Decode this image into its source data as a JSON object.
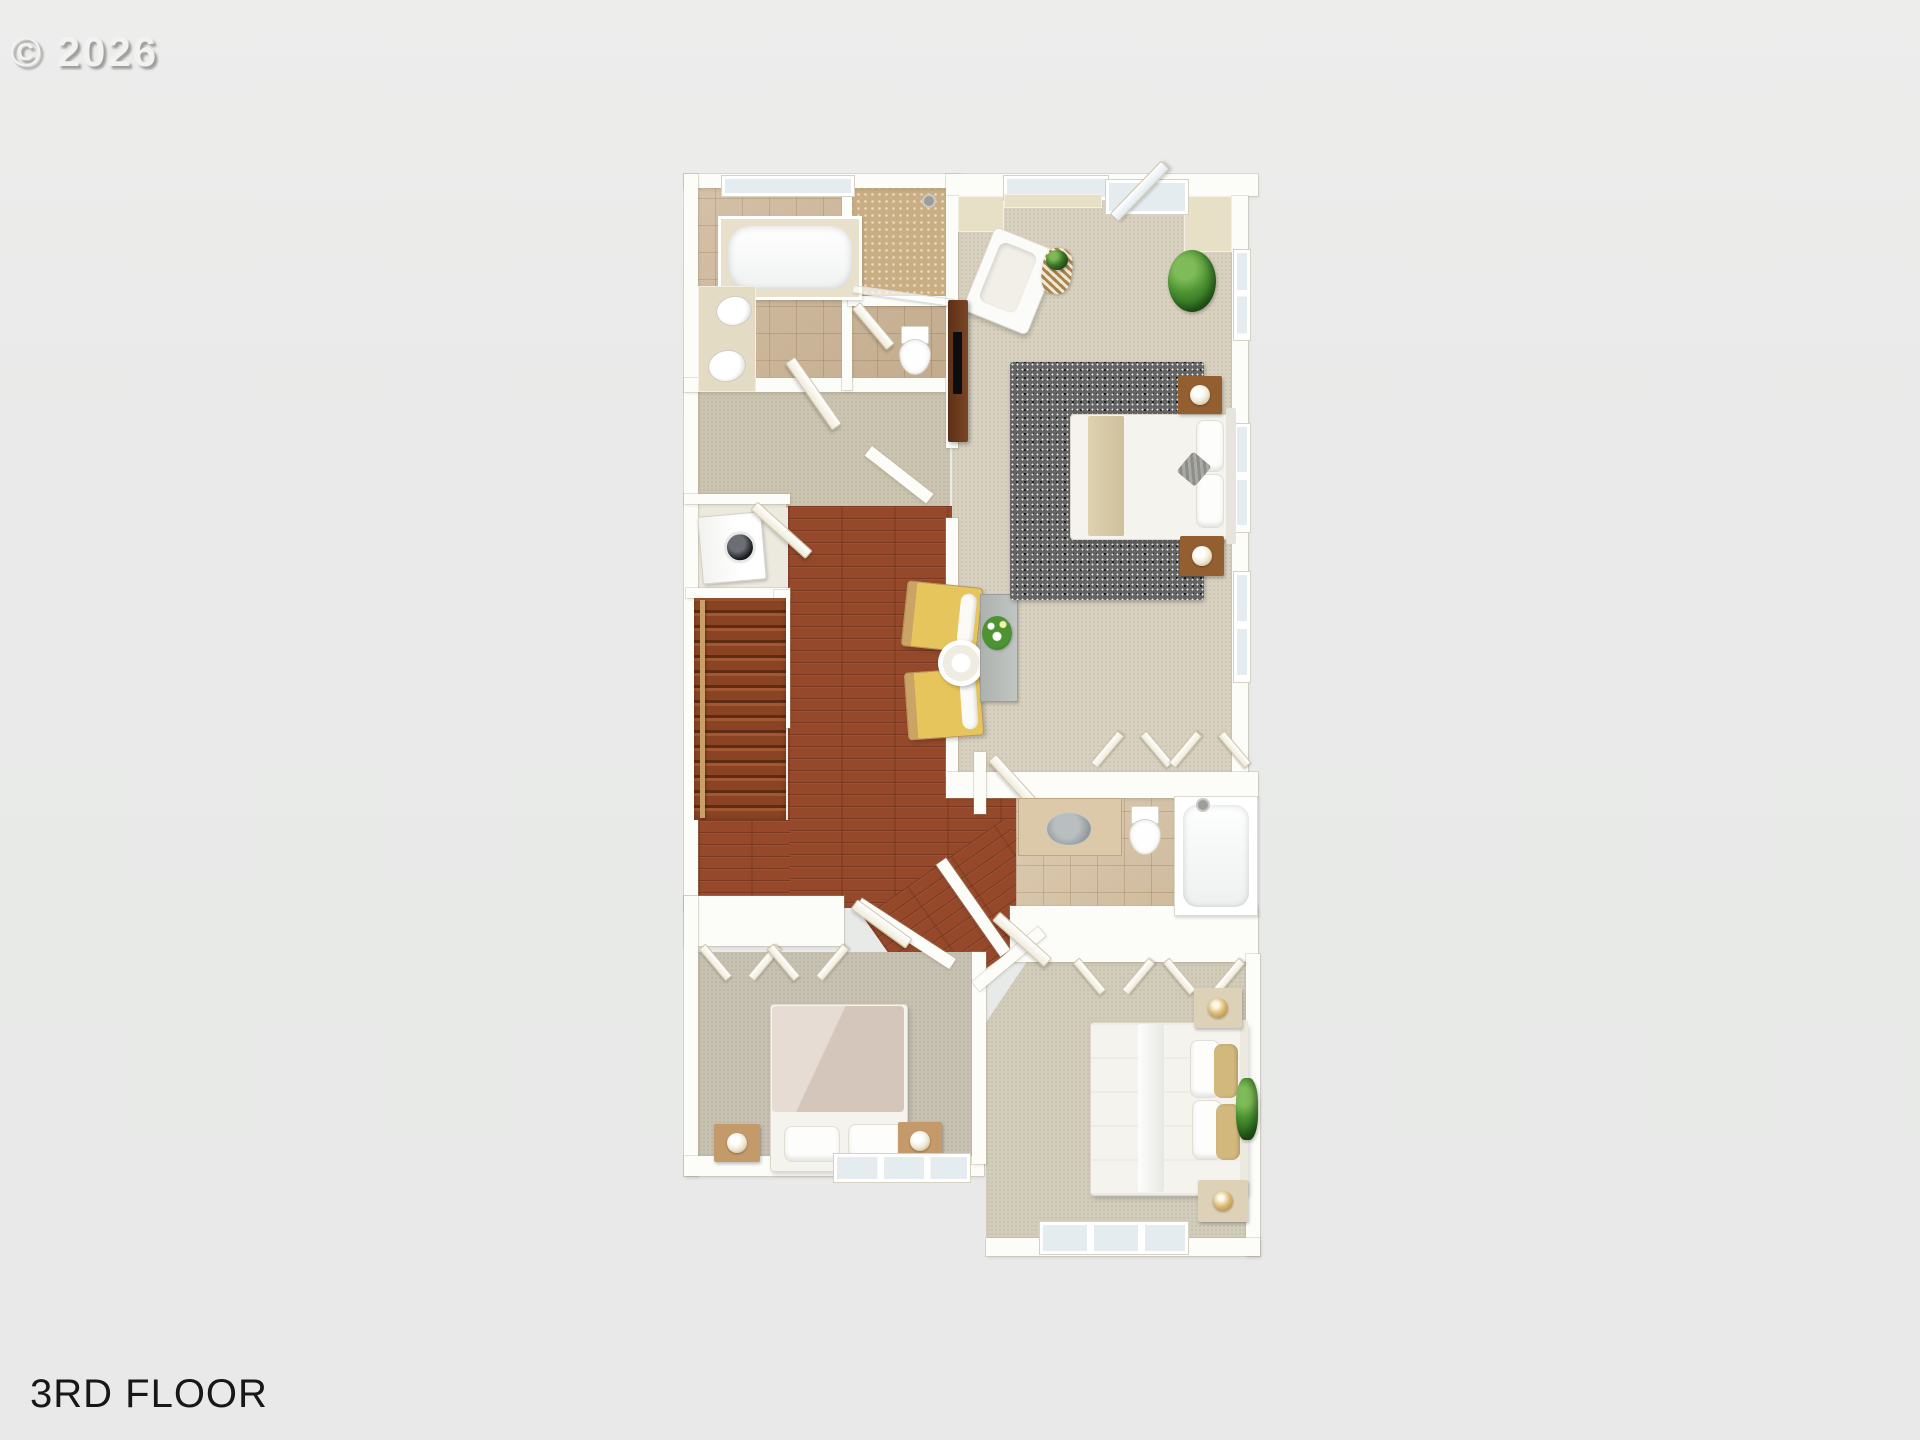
{
  "watermark": {
    "text": "© 2026"
  },
  "caption": {
    "text": "3RD FLOOR"
  },
  "scene": {
    "type": "3d-floorplan-render",
    "floor_label": "3RD FLOOR",
    "rooms": [
      {
        "name": "master bathroom",
        "fixtures": [
          "bathtub",
          "double vanity sinks",
          "walk-in shower",
          "water closet toilet",
          "window"
        ]
      },
      {
        "name": "hallway",
        "fixtures": [
          "carpet",
          "doors"
        ]
      },
      {
        "name": "laundry closet",
        "fixtures": [
          "washer-dryer"
        ]
      },
      {
        "name": "staircase",
        "fixtures": [
          "wood treads",
          "handrail",
          "half wall"
        ]
      },
      {
        "name": "loft",
        "fixtures": [
          "hardwood floor",
          "two yellow armchairs",
          "round side table",
          "gray console with flowers"
        ]
      },
      {
        "name": "master bedroom",
        "fixtures": [
          "bed with tan throw",
          "two wood nightstands with lamps",
          "white armchair",
          "striped side table",
          "potted plant",
          "dark dresser with tv",
          "gray area rug",
          "bay window",
          "balcony door",
          "two closets",
          "windows"
        ]
      },
      {
        "name": "hall bathroom",
        "fixtures": [
          "vanity with gray sink",
          "toilet",
          "bathtub with shower"
        ]
      },
      {
        "name": "bedroom 2",
        "fixtures": [
          "bed with blush duvet",
          "two wood nightstands",
          "closet",
          "window"
        ]
      },
      {
        "name": "bedroom 3",
        "fixtures": [
          "bed with tan pillows",
          "two cream nightstands with gold lamps",
          "closet",
          "plant",
          "window"
        ]
      }
    ],
    "palette": {
      "background": "#e9eae9",
      "wall": "#fcfcf9",
      "wall_face_cream": "#e7dfc6",
      "tile": "#cdb698",
      "shower_mosaic": "#c9ad83",
      "hardwood": "#95492a",
      "stair_tread": "#8a4424",
      "hall_carpet": "#cbc4b0",
      "master_carpet": "#d8d1c0",
      "bedroom2_carpet": "#c7c1b1",
      "bedroom3_carpet": "#d2ccbb",
      "area_rug": "#636363",
      "accent_chair_yellow": "#e6c55c",
      "tan_textile": "#d3b87e",
      "blush_duvet": "#d9cdc3",
      "dresser_brown": "#6e3c1e",
      "plant_green": "#3f7d2c",
      "lamp_gold": "#c49a4a",
      "caption_text": "#171717",
      "watermark_text": "#f2f2f1"
    }
  }
}
